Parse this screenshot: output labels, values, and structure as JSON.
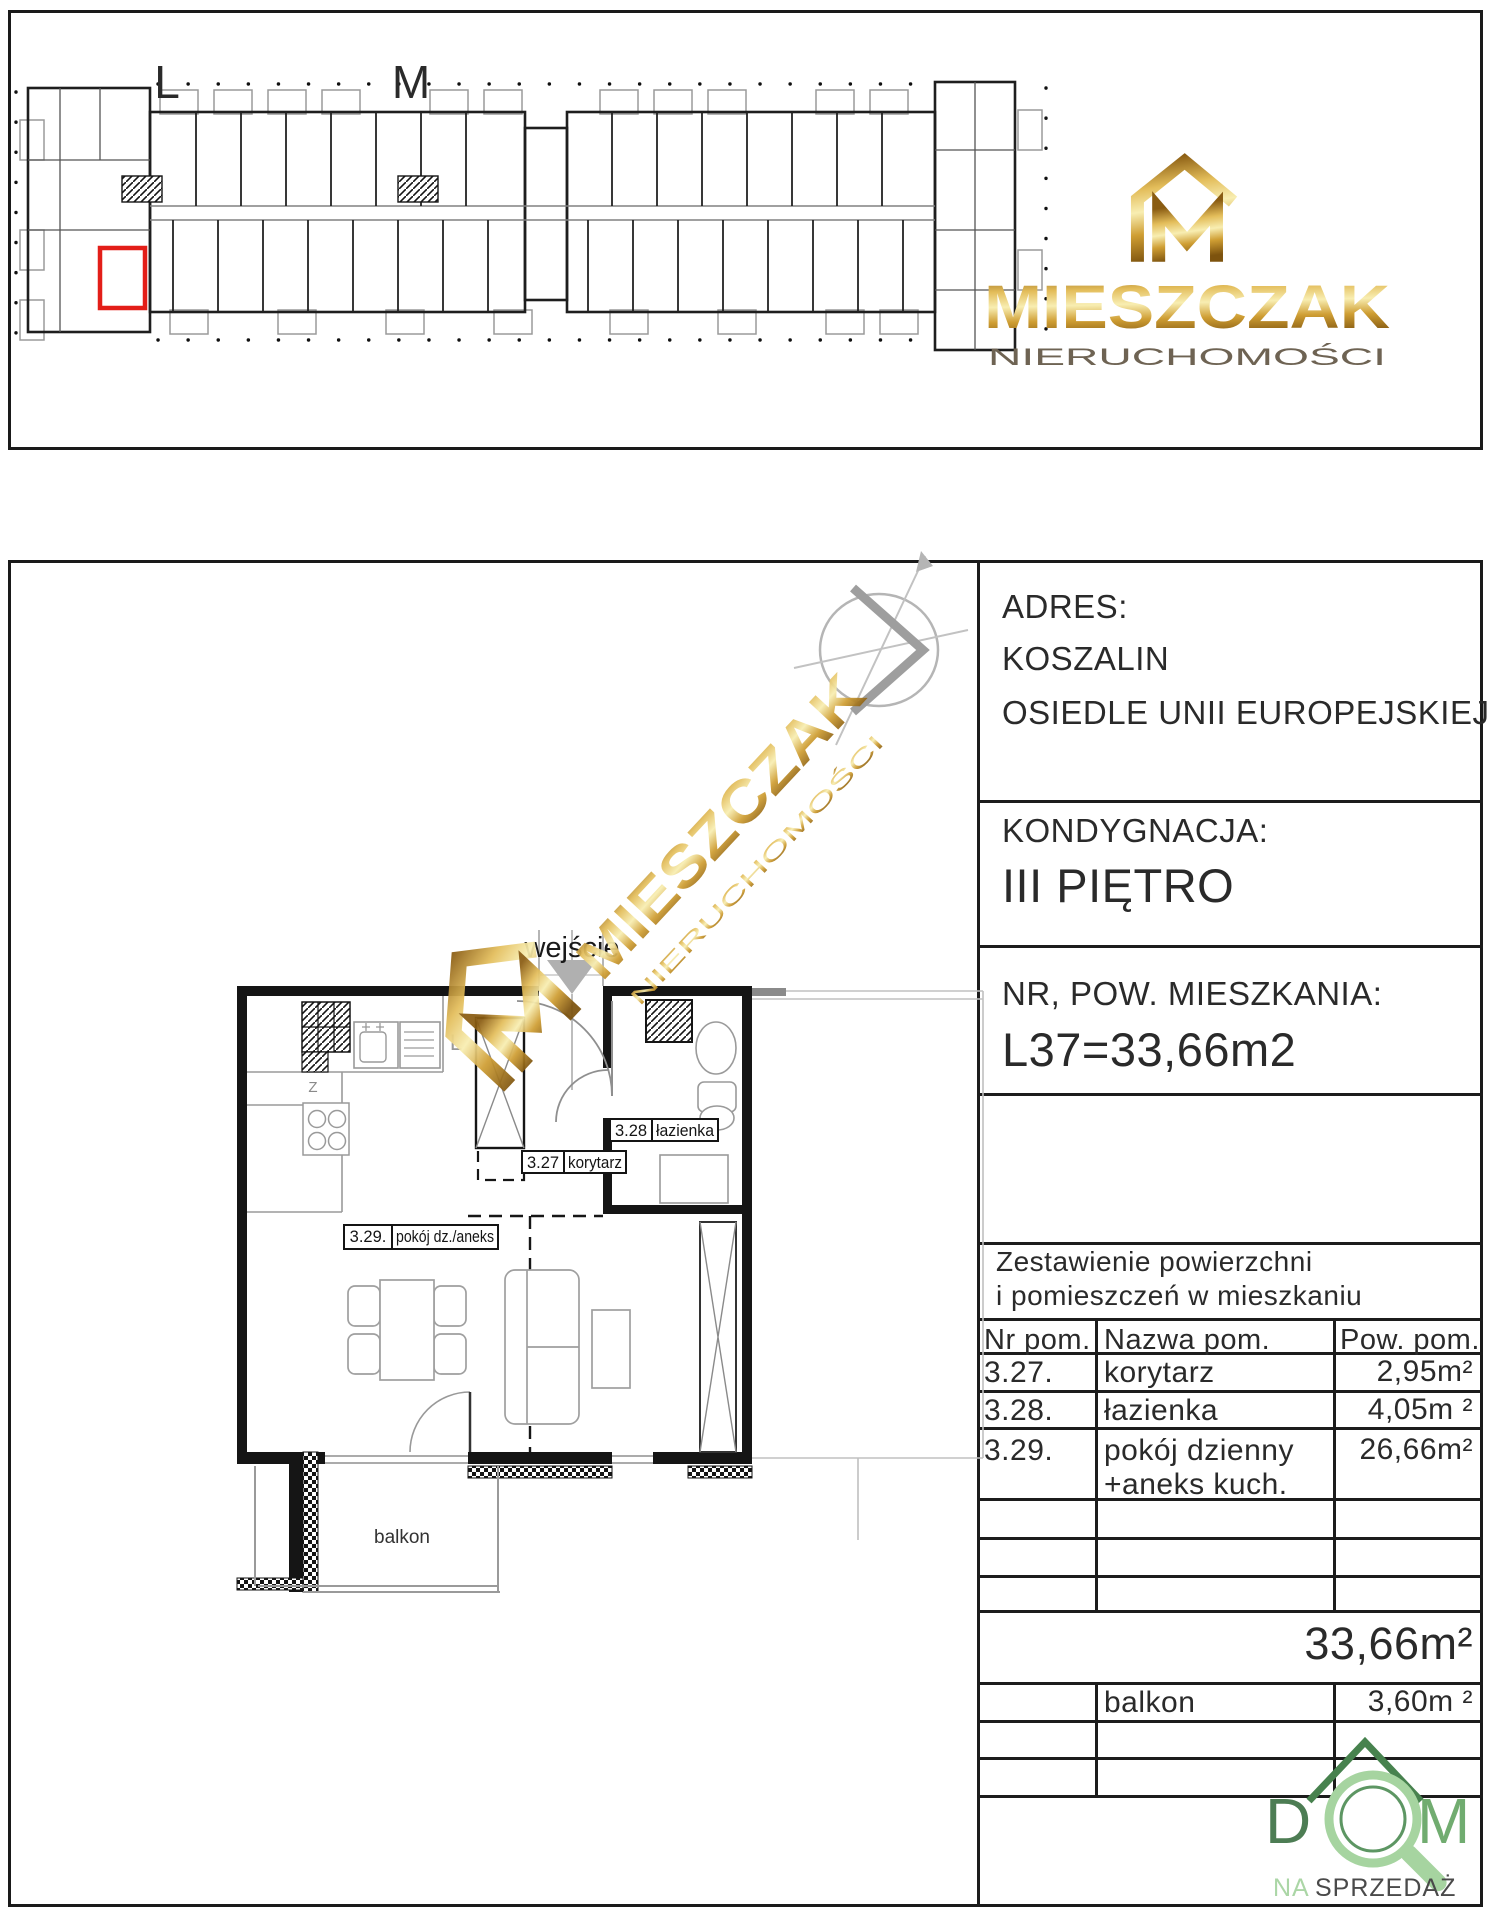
{
  "overview": {
    "section_l": "L",
    "section_m": "M",
    "highlighted_unit": "L37"
  },
  "brand": {
    "name": "MIESZCZAK",
    "subtitle": "NIERUCHOMOŚCI"
  },
  "plan": {
    "entrance_label": "wejście",
    "balcony_label": "balkon",
    "kitchen_l": "L",
    "kitchen_z": "Z",
    "rooms": [
      {
        "nr": "3.27",
        "name": "korytarz"
      },
      {
        "nr": "3.28",
        "name": "łazienka"
      },
      {
        "nr": "3.29.",
        "name": "pokój dz./aneks"
      }
    ]
  },
  "info": {
    "address_label": "ADRES:",
    "address_line1": "KOSZALIN",
    "address_line2": "OSIEDLE UNII EUROPEJSKIEJ",
    "floor_label": "KONDYGNACJA:",
    "floor_value": "III PIĘTRO",
    "unit_label": "NR, POW. MIESZKANIA:",
    "unit_value": "L37=33,66m2"
  },
  "table": {
    "title_line1": "Zestawienie powierzchni",
    "title_line2": "i pomieszczeń w mieszkaniu",
    "headers": [
      "Nr pom.",
      "Nazwa pom.",
      "Pow. pom."
    ],
    "rows": [
      {
        "nr": "3.27.",
        "name": "korytarz",
        "area": "2,95m²"
      },
      {
        "nr": "3.28.",
        "name": "łazienka",
        "area": "4,05m ²"
      },
      {
        "nr": "3.29.",
        "name": "pokój dzienny",
        "name2": "+aneks kuch.",
        "area": "26,66m²"
      }
    ],
    "total_area": "33,66m²",
    "balcony_row": {
      "name": "balkon",
      "area": "3,60m ²"
    }
  },
  "footer_logo": {
    "d": "D",
    "m": "M",
    "na": "NA",
    "sprzedaz": "SPRZEDAŻ"
  },
  "colors": {
    "highlight_red": "#e31e18",
    "gold": "#c79a37",
    "logo_green_dark": "#4d7d54",
    "logo_green_light": "#a6d4a0"
  }
}
